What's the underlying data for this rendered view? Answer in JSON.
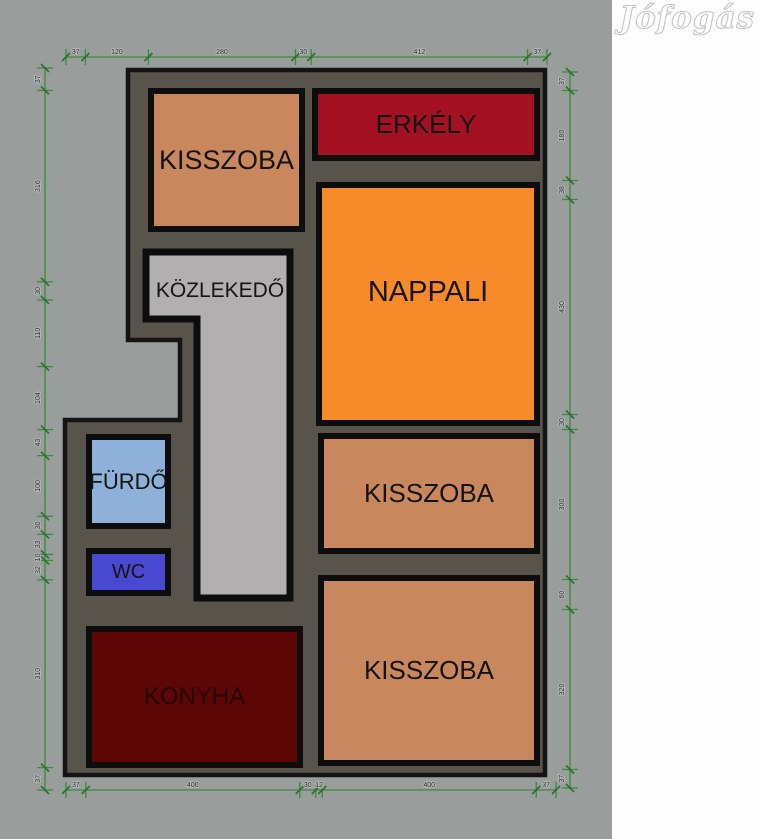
{
  "watermark": {
    "text": "Jófogás"
  },
  "plan": {
    "rooms": {
      "kisszoba_top": {
        "label": "KISSZOBA",
        "fill": "#c9875d"
      },
      "erkely": {
        "label": "ERKÉLY",
        "fill": "#a41122"
      },
      "nappali": {
        "label": "NAPPALI",
        "fill": "#f78b2a"
      },
      "kozlekedo": {
        "label": "KÖZLEKEDŐ",
        "fill": "#b1afaf"
      },
      "furdo": {
        "label": "FÜRDŐ",
        "fill": "#8db1d9"
      },
      "wc": {
        "label": "WC",
        "fill": "#4848d1"
      },
      "konyha": {
        "label": "KONYHA",
        "fill": "#5c0606"
      },
      "kisszoba_mid": {
        "label": "KISSZOBA",
        "fill": "#c9875d"
      },
      "kisszoba_bottom": {
        "label": "KISSZOBA",
        "fill": "#c9875d"
      }
    },
    "colors": {
      "page_background": "#999e9d",
      "outside_strip": "#fdfdfd",
      "wall_fill": "#59544b",
      "wall_outline": "#141414",
      "room_border": "#0d0d0d",
      "dimension_line": "#3c8a3c",
      "dimension_label": "#2a2a2a"
    },
    "dimensions": {
      "top": [
        "37",
        "120",
        "280",
        "30",
        "412",
        "37"
      ],
      "bottom": [
        "37",
        "400",
        "30",
        "12",
        "400",
        "37"
      ],
      "left": [
        "37",
        "316",
        "30",
        "110",
        "104",
        "43",
        "100",
        "30",
        "33",
        "10",
        "32",
        "310",
        "37"
      ],
      "right": [
        "37",
        "180",
        "38",
        "430",
        "30",
        "300",
        "60",
        "320",
        "37"
      ]
    }
  }
}
